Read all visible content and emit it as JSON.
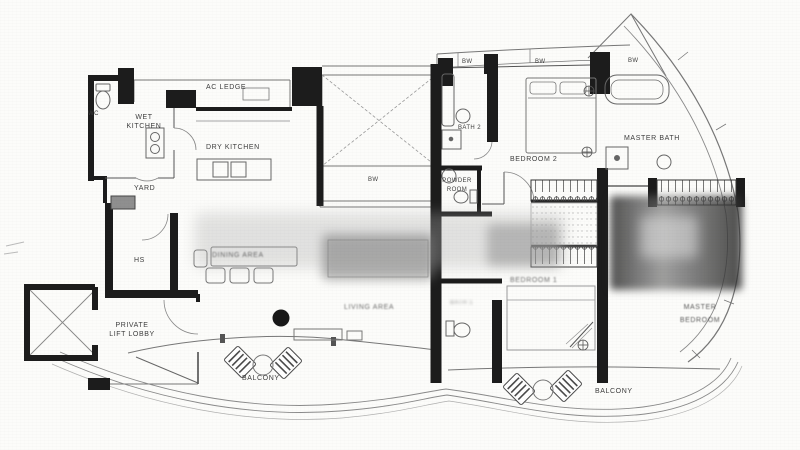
{
  "meta": {
    "type": "floor-plan",
    "description": "Scanned condominium floor plan drawing"
  },
  "colors": {
    "wall": "#1c1c1c",
    "line": "#6a6a6a",
    "paper": "#fcfcfa",
    "label": "#3d3d3d"
  },
  "labels": {
    "ac_ledge": "AC LEDGE",
    "wc": "WC",
    "wet_kitchen": "WET\nKITCHEN",
    "dry_kitchen": "DRY KITCHEN",
    "yard": "YARD",
    "hs": "HS",
    "dining_area": "DINING AREA",
    "private_lift_lobby": "PRIVATE\nLIFT LOBBY",
    "living_area": "LIVING AREA",
    "balcony": "BALCONY",
    "bw": "BW",
    "powder_room": "POWDER\nROOM",
    "bath_2": "BATH 2",
    "bath_1": "BATH 1",
    "bedroom_2": "BEDROOM 2",
    "bedroom_1": "BEDROOM 1",
    "master_bath": "MASTER BATH",
    "master_bedroom": "MASTER\nBEDROOM"
  }
}
